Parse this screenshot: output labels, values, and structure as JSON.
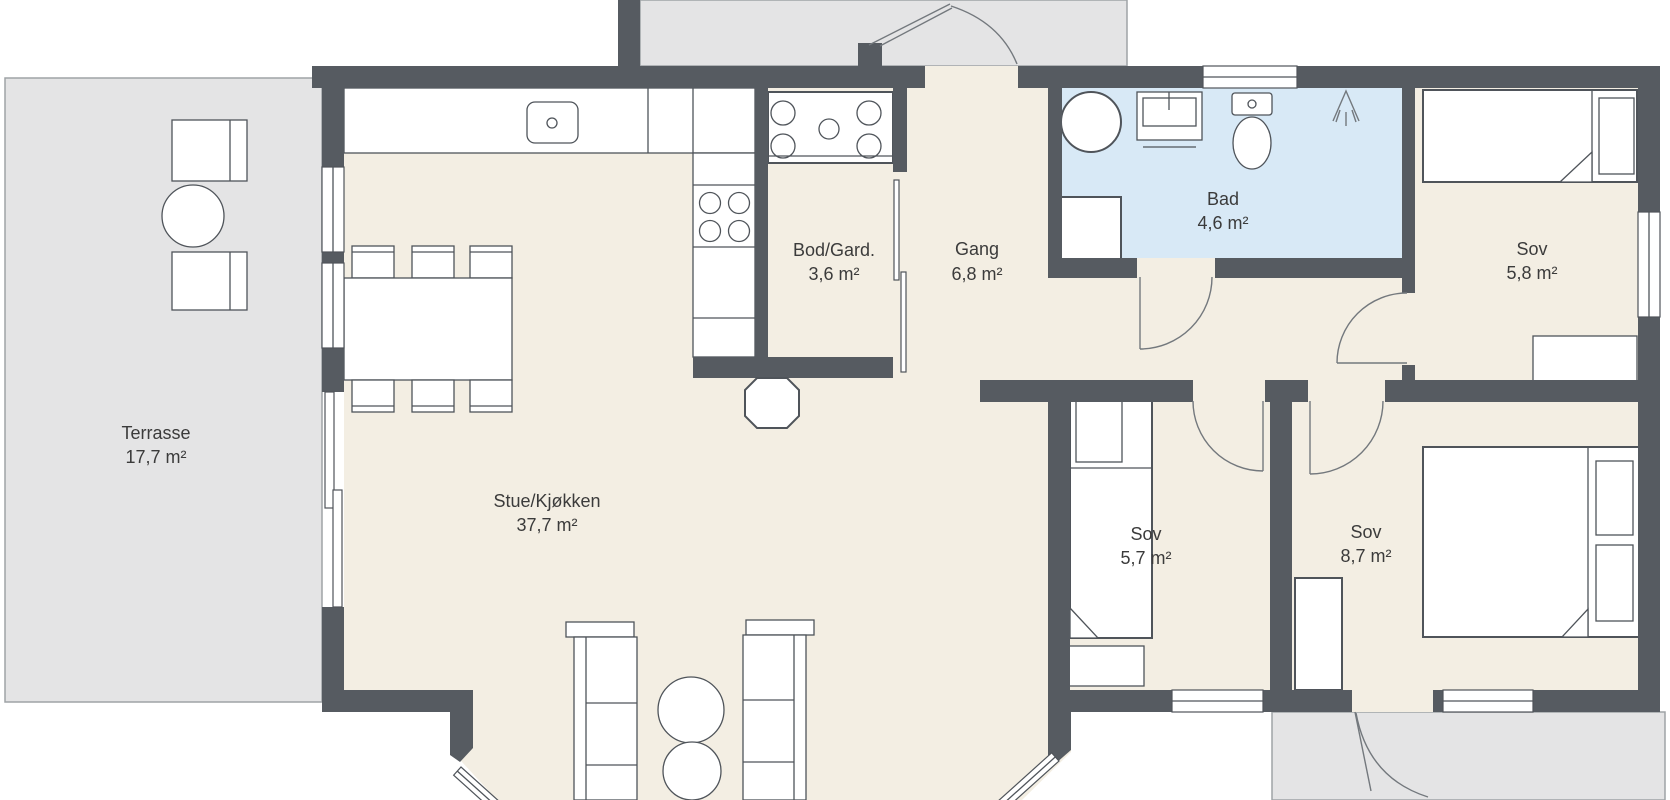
{
  "rooms": {
    "terrasse": {
      "name": "Terrasse",
      "area": "17,7 m²"
    },
    "stue": {
      "name": "Stue/Kjøkken",
      "area": "37,7 m²"
    },
    "bod": {
      "name": "Bod/Gard.",
      "area": "3,6 m²"
    },
    "gang": {
      "name": "Gang",
      "area": "6,8 m²"
    },
    "bad": {
      "name": "Bad",
      "area": "4,6 m²"
    },
    "sov_top": {
      "name": "Sov",
      "area": "5,8 m²"
    },
    "sov_mid": {
      "name": "Sov",
      "area": "5,7 m²"
    },
    "sov_right": {
      "name": "Sov",
      "area": "8,7 m²"
    }
  },
  "colors": {
    "bg": "#ffffff",
    "wall": "#565b61",
    "floor": "#f3eee3",
    "bath": "#d8e9f6",
    "outdoor": "#e4e4e5",
    "outdoorBorder": "#9fa3a6",
    "outline": "#4f545a",
    "arcColor": "#73787d",
    "text": "#3b3b3b"
  },
  "icons": {
    "kitchen-sink-icon": "rounded-square-with-dot",
    "cooktop-icon": "four-circles",
    "stove-icon": "four-circles-with-center-dot",
    "washing-machine-icon": "large-circle",
    "bathroom-cabinet-icon": "white-square",
    "bathroom-sink-icon": "basin-with-tap",
    "toilet-icon": "tank-and-bowl",
    "shower-icon": "spray-arrow",
    "chimney-icon": "octagon"
  }
}
